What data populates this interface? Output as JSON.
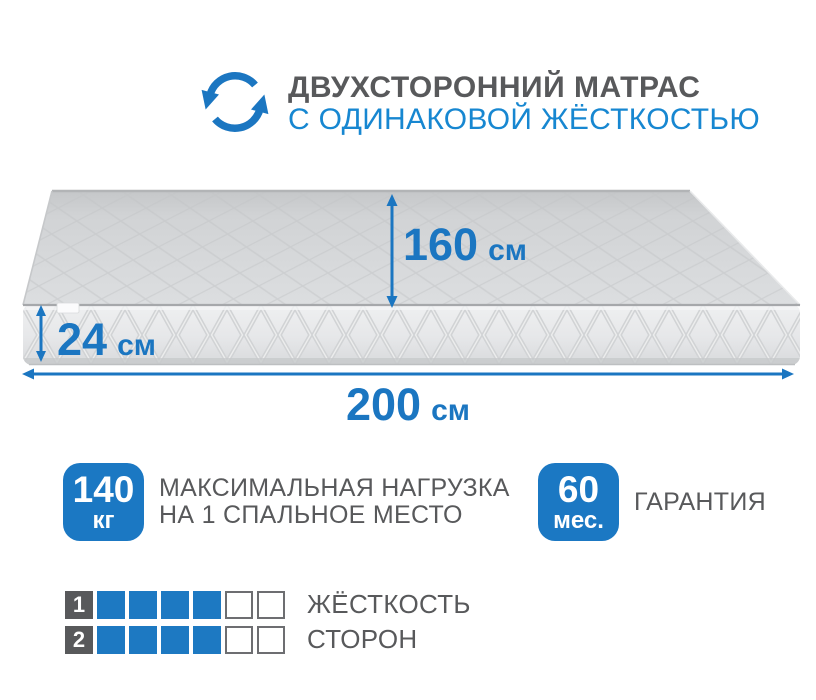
{
  "header": {
    "icon": "flip-arrows-icon",
    "title_line1": "ДВУХСТОРОННИЙ МАТРАС",
    "title_line2": "С ОДИНАКОВОЙ ЖЁСТКОСТЬЮ"
  },
  "dimensions": {
    "width": {
      "value": "160",
      "unit": "см"
    },
    "thickness": {
      "value": "24",
      "unit": "см"
    },
    "length": {
      "value": "200",
      "unit": "см"
    }
  },
  "features": [
    {
      "value": "140",
      "unit": "кг",
      "label_line1": "МАКСИМАЛЬНАЯ НАГРУЗКА",
      "label_line2": "НА 1 СПАЛЬНОЕ МЕСТО"
    },
    {
      "value": "60",
      "unit": "мес.",
      "label_line1": "ГАРАНТИЯ",
      "label_line2": ""
    }
  ],
  "hardness": {
    "label_line1": "ЖЁСТКОСТЬ",
    "label_line2": "СТОРОН",
    "rows": [
      {
        "label": "1",
        "filled": 4,
        "total": 6
      },
      {
        "label": "2",
        "filled": 4,
        "total": 6
      }
    ]
  },
  "colors": {
    "accent_blue": "#1b76c1",
    "title_blue": "#1787d1",
    "badge_blue": "#1b78c3",
    "square_blue": "#1d79c2",
    "text_gray": "#58595b"
  }
}
